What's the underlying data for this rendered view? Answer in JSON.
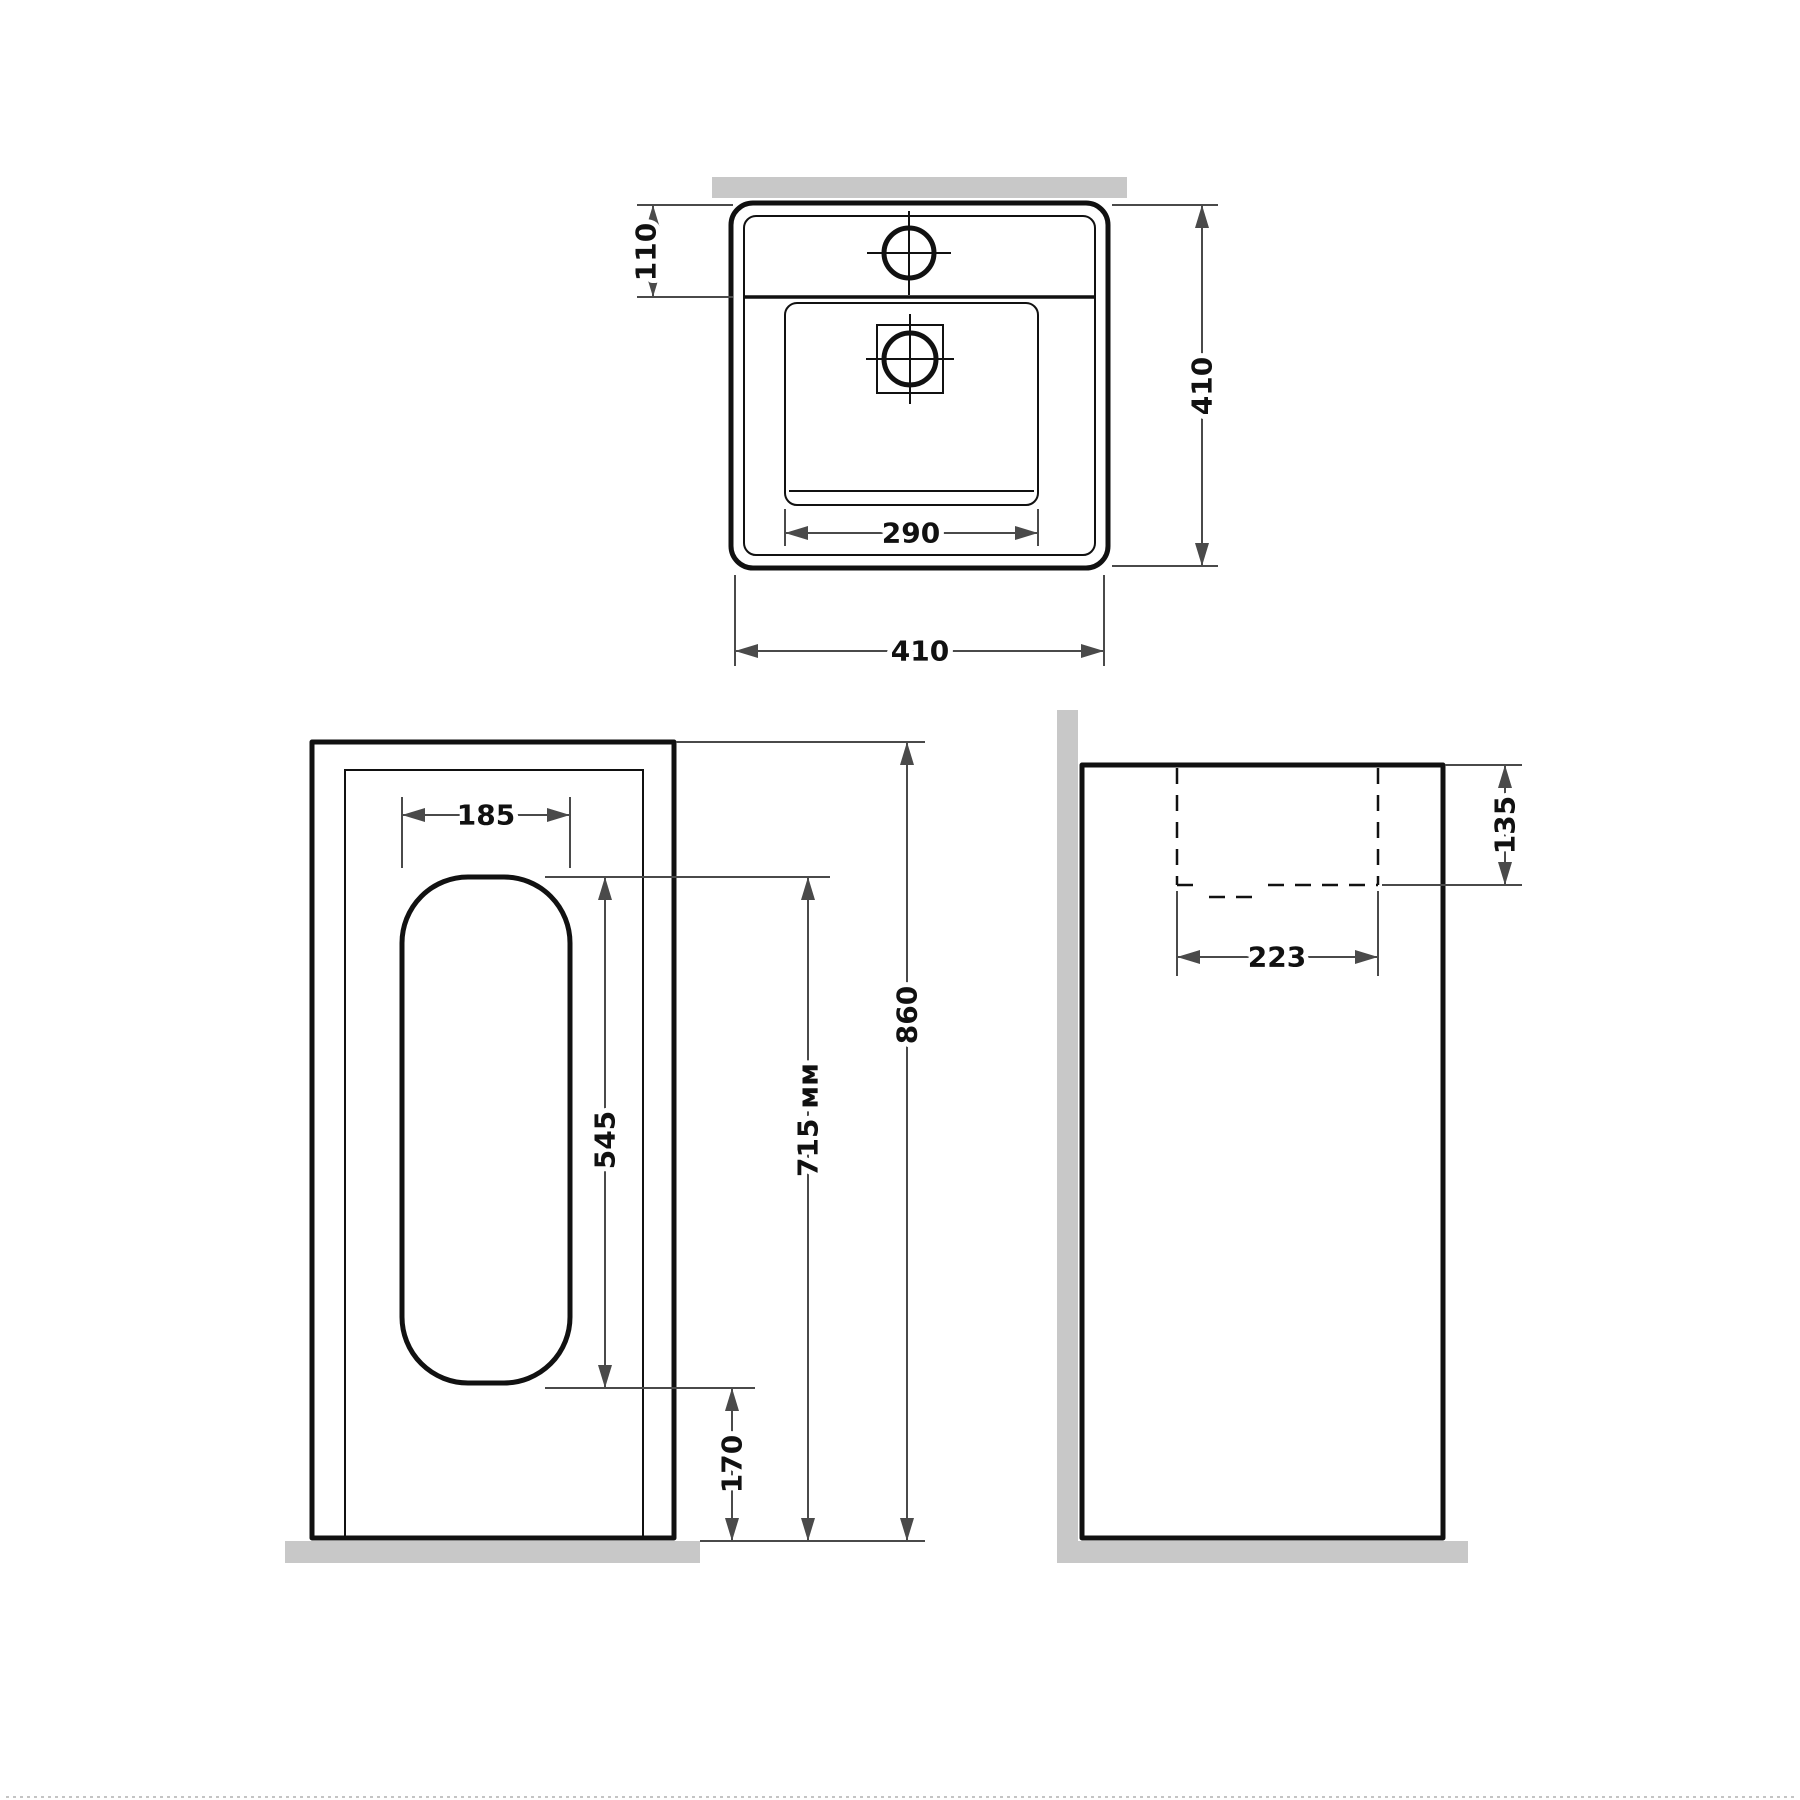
{
  "top_view": {
    "deck_depth": "110",
    "drain_opening_width": "290",
    "overall_width": "410",
    "overall_depth": "410"
  },
  "front_view": {
    "cutout_width": "185",
    "cutout_height": "545",
    "rim_height_label": "715 мм",
    "overall_height": "860",
    "cutout_floor_offset": "170"
  },
  "side_view": {
    "bowl_depth": "135",
    "bowl_length": "223"
  },
  "colors": {
    "outline": "#111111",
    "dimension": "#4a4a4a",
    "wall_floor_surface": "#c8c8c8",
    "background": "#ffffff"
  }
}
